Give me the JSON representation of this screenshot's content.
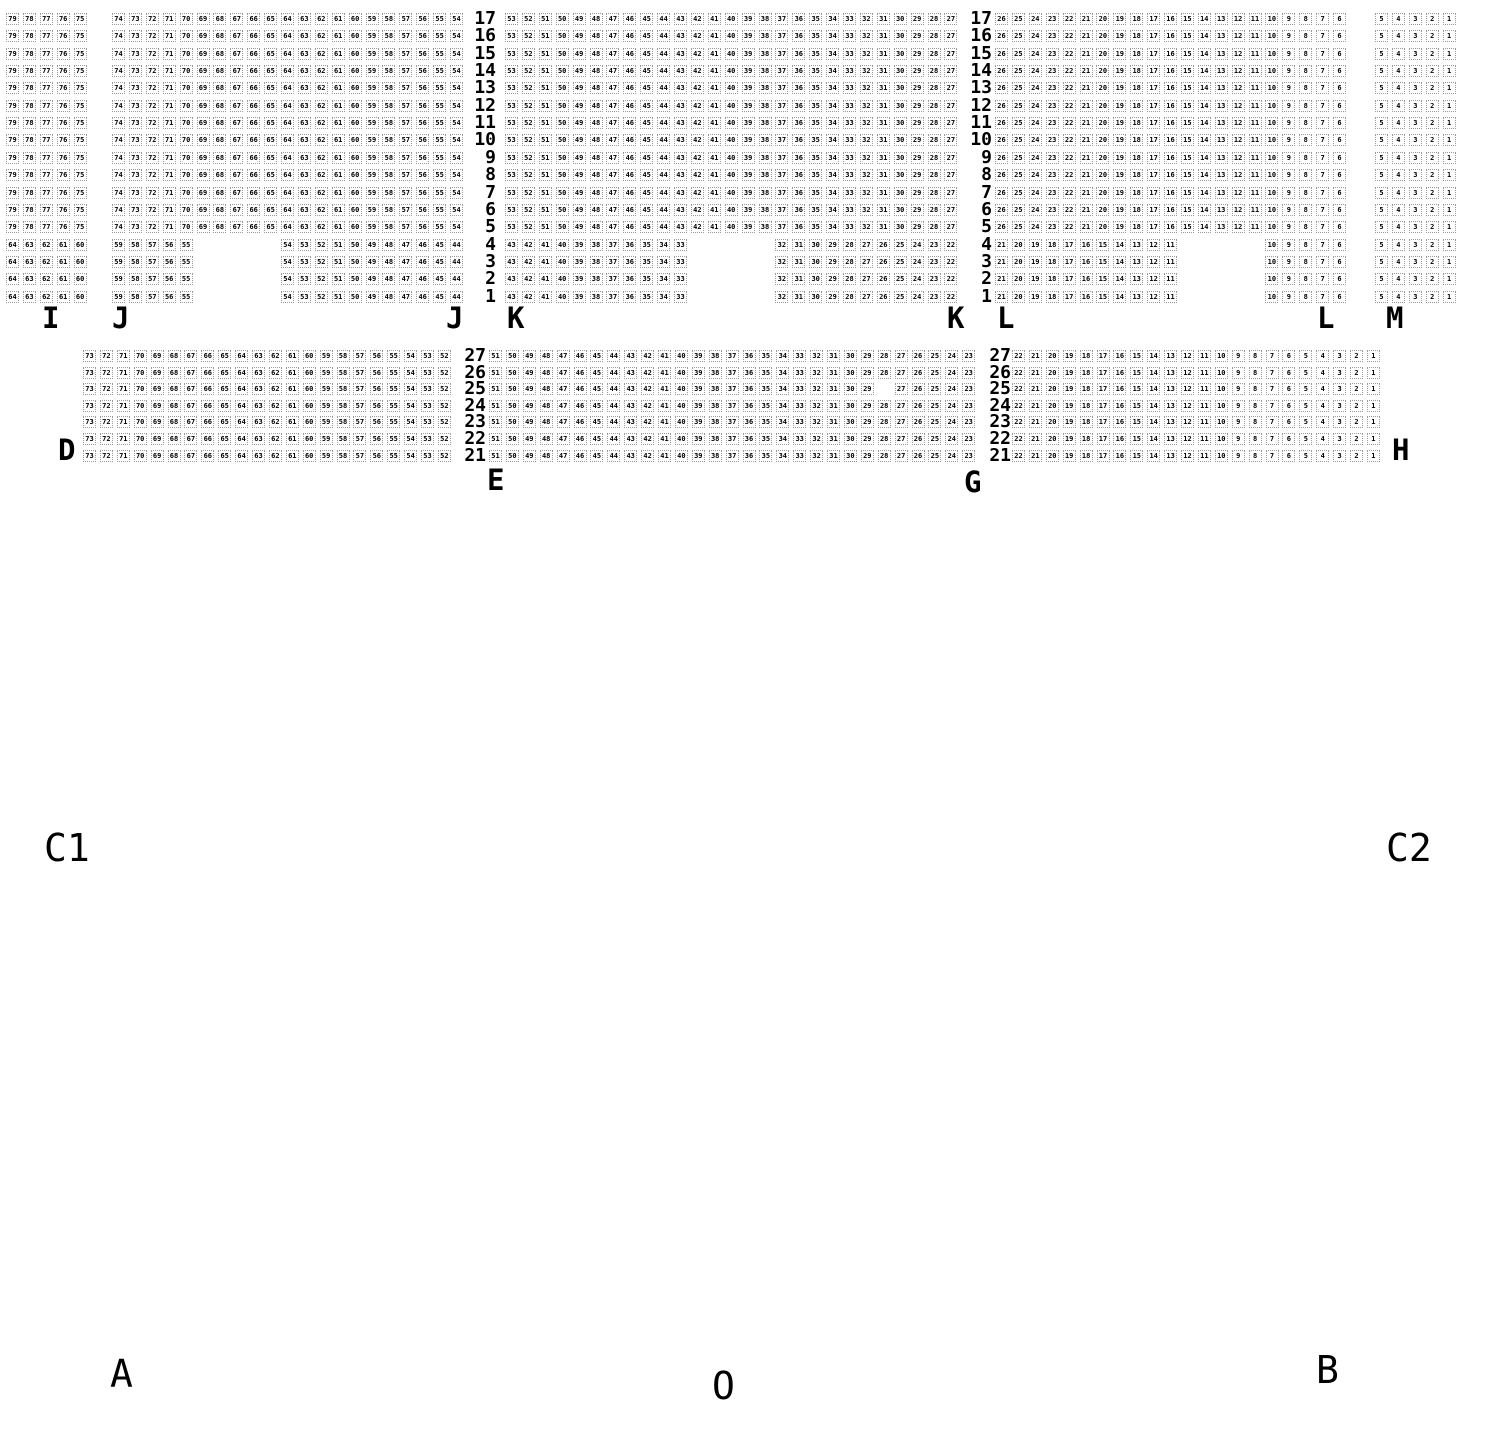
{
  "style": {
    "pitch_x": 16.9,
    "seat_border": "#9a9a9a",
    "seat_text": "#000000"
  },
  "upper_band": {
    "top": 13,
    "pitch_y": 17.35,
    "row_from": 17,
    "row_to": 1,
    "partial_rows_from": 4,
    "row_label_x": [
      496,
      992
    ],
    "blocks": [
      {
        "section": "I",
        "x": 6,
        "full": [
          79,
          75
        ],
        "partial": [
          {
            "col": 0,
            "from": 64,
            "to": 60
          }
        ]
      },
      {
        "section": "J",
        "x": 112,
        "full": [
          74,
          54
        ],
        "partial": [
          {
            "col": 0,
            "from": 59,
            "to": 55
          },
          {
            "col": 10,
            "from": 54,
            "to": 44
          }
        ]
      },
      {
        "section": "K",
        "x": 505,
        "full": [
          53,
          27
        ],
        "partial": [
          {
            "col": 0,
            "from": 43,
            "to": 33
          },
          {
            "col": 16,
            "from": 32,
            "to": 22
          }
        ]
      },
      {
        "section": "L",
        "x": 995,
        "full": [
          26,
          6
        ],
        "partial": [
          {
            "col": 0,
            "from": 21,
            "to": 11
          },
          {
            "col": 16,
            "from": 10,
            "to": 6
          }
        ]
      },
      {
        "section": "M",
        "x": 1375,
        "full": [
          5,
          1
        ],
        "partial": [
          {
            "col": 0,
            "from": 5,
            "to": 1
          }
        ]
      }
    ]
  },
  "lower_band": {
    "top": 350,
    "pitch_y": 16.6,
    "row_from": 27,
    "row_to": 21,
    "row_label_x": [
      486,
      1011
    ],
    "blocks": [
      {
        "section": "D",
        "x": 83,
        "full": [
          73,
          52
        ]
      },
      {
        "section": "E",
        "x": 489,
        "full": [
          51,
          23
        ],
        "missing": [
          {
            "row": 25,
            "seat": 28
          }
        ]
      },
      {
        "section": "H",
        "x": 1012,
        "full": [
          22,
          1
        ]
      }
    ]
  },
  "section_labels": [
    {
      "text": "I",
      "x": 42,
      "y": 304
    },
    {
      "text": "J",
      "x": 112,
      "y": 304
    },
    {
      "text": "J",
      "x": 446,
      "y": 304
    },
    {
      "text": "K",
      "x": 507,
      "y": 304
    },
    {
      "text": "K",
      "x": 947,
      "y": 304
    },
    {
      "text": "L",
      "x": 997,
      "y": 304
    },
    {
      "text": "L",
      "x": 1317,
      "y": 304
    },
    {
      "text": "M",
      "x": 1386,
      "y": 304
    },
    {
      "text": "D",
      "x": 58,
      "y": 436
    },
    {
      "text": "E",
      "x": 487,
      "y": 466
    },
    {
      "text": "G",
      "x": 964,
      "y": 468
    },
    {
      "text": "H",
      "x": 1392,
      "y": 436
    }
  ],
  "area_labels": [
    {
      "text": "C1",
      "x": 44,
      "y": 828
    },
    {
      "text": "C2",
      "x": 1386,
      "y": 828
    },
    {
      "text": "A",
      "x": 110,
      "y": 1354
    },
    {
      "text": "O",
      "x": 712,
      "y": 1366
    },
    {
      "text": "B",
      "x": 1316,
      "y": 1350
    }
  ]
}
